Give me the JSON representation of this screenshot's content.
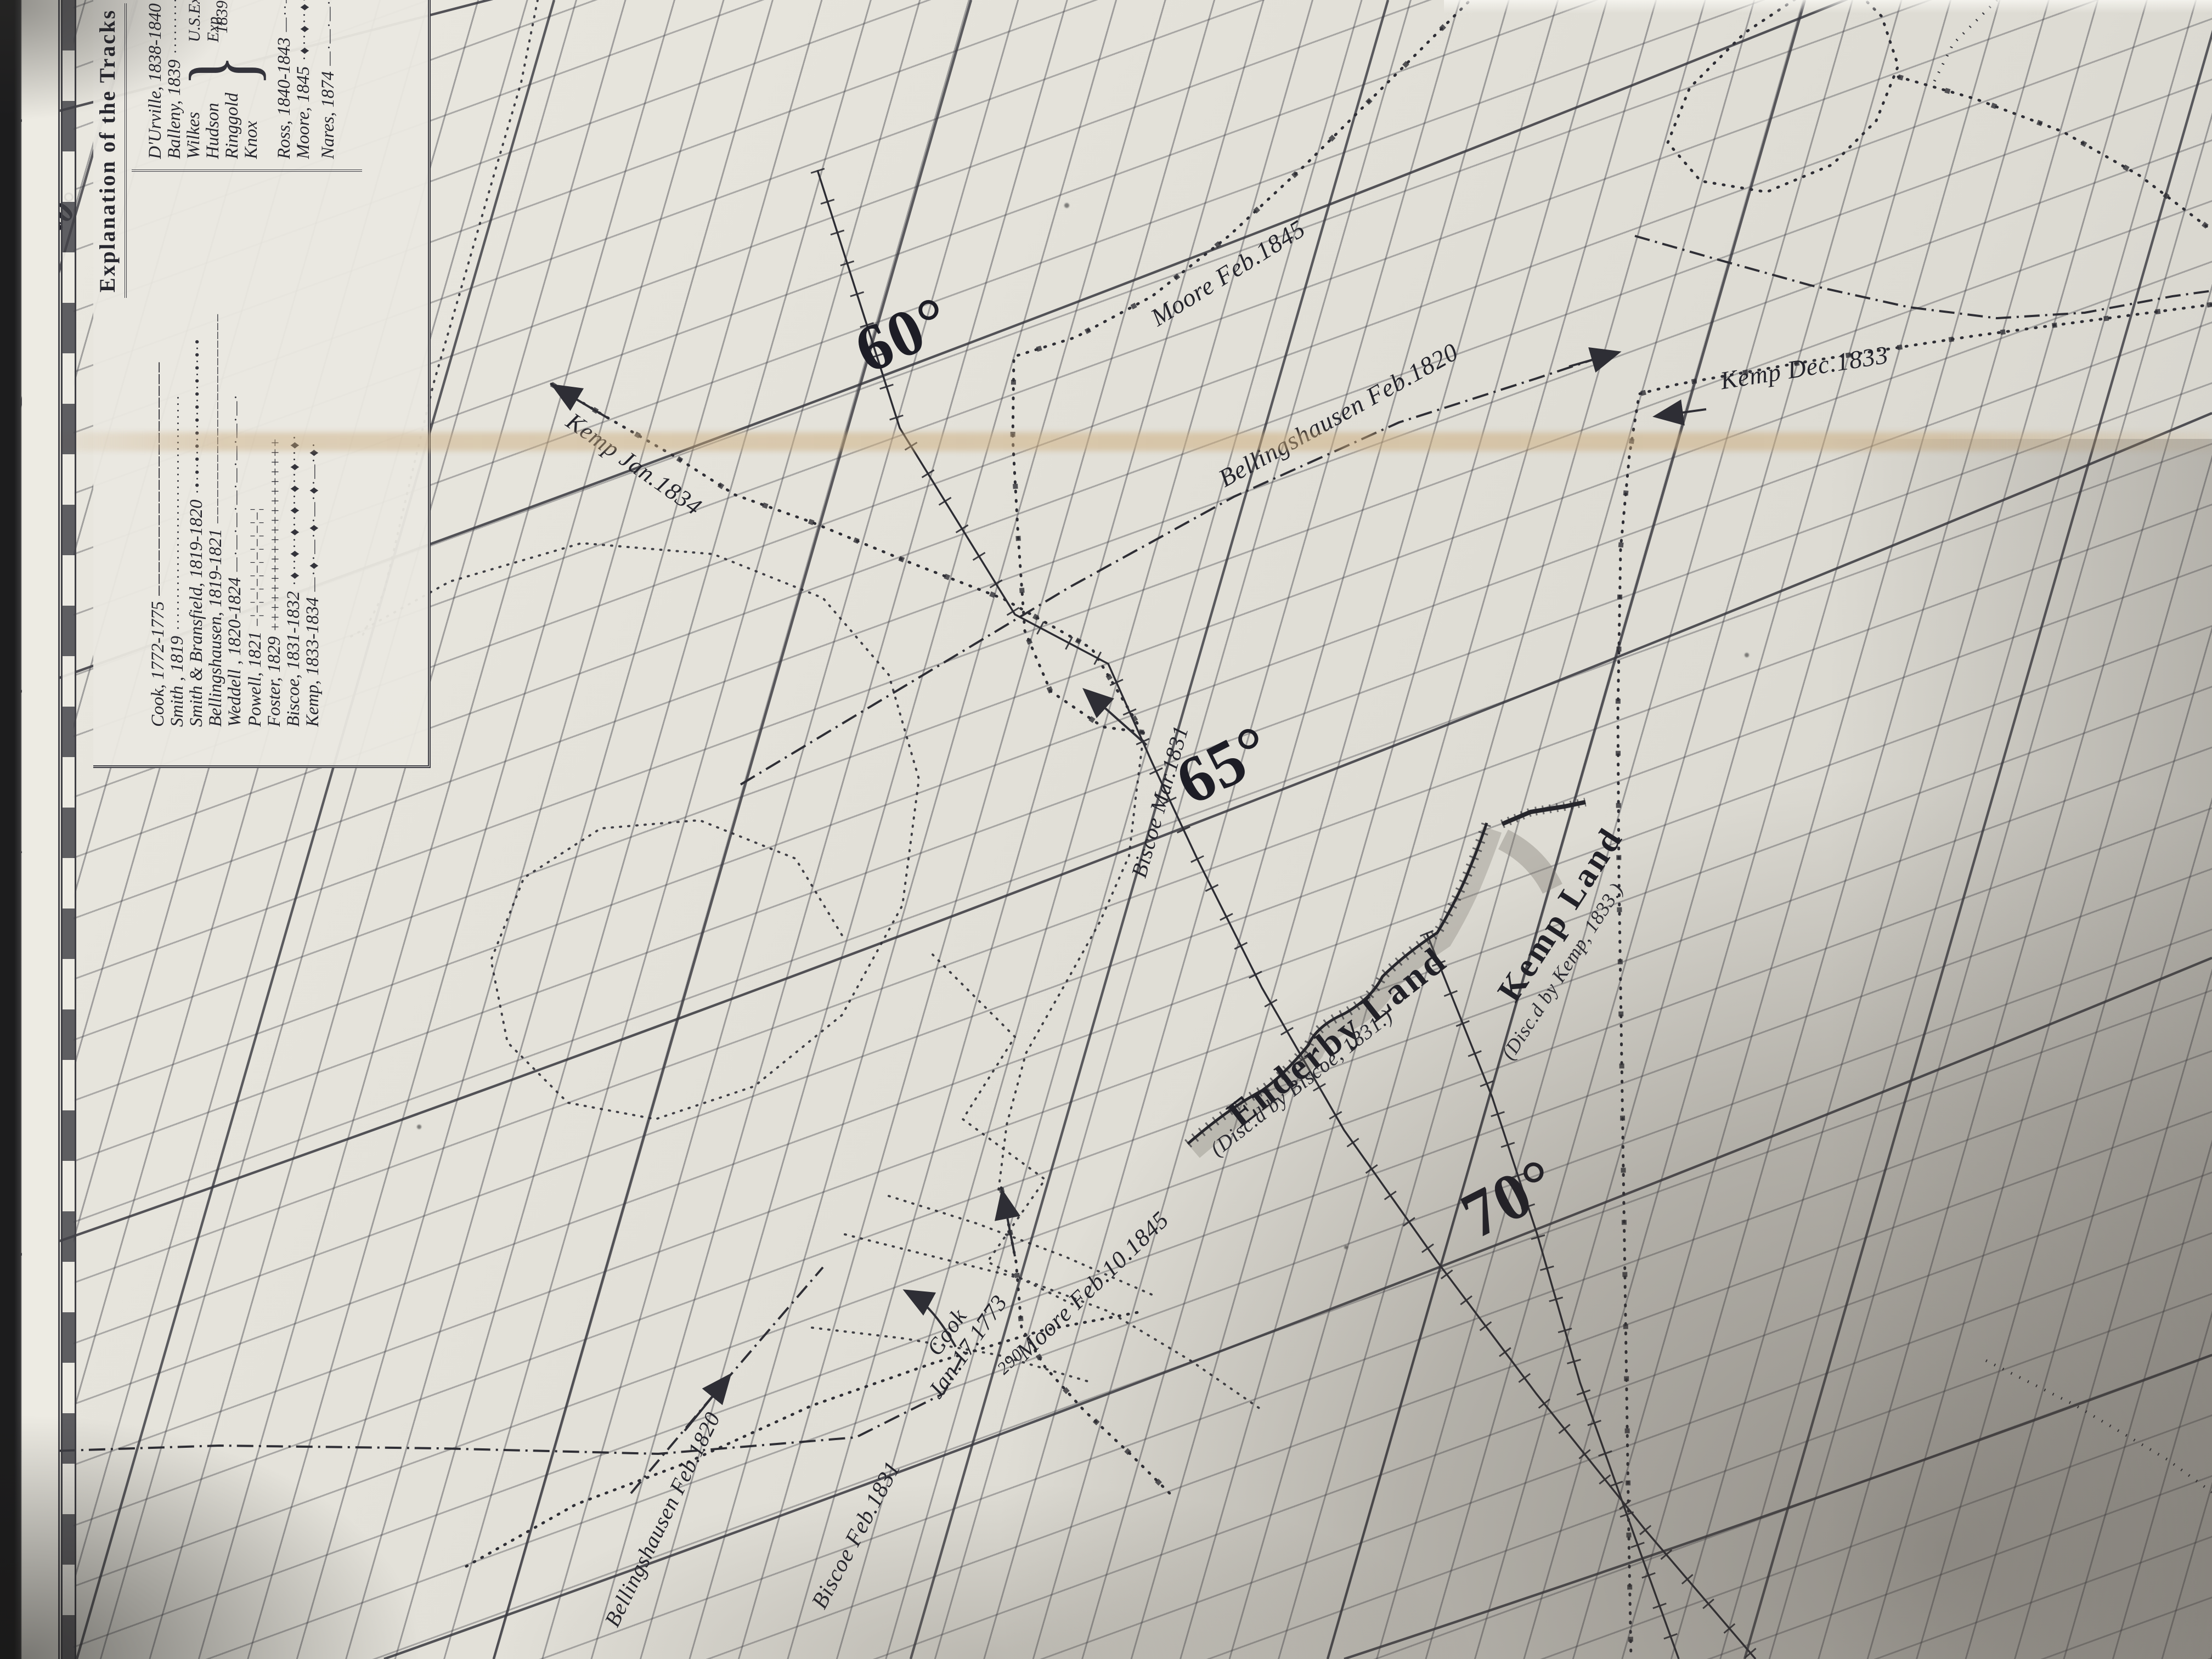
{
  "colors": {
    "paper": "#e3e1d8",
    "ink": "#24242c",
    "grid_line": "#3e3e46",
    "crease": "#c9a878"
  },
  "legend": {
    "title": "Explanation of the Tracks",
    "left_entries": [
      {
        "name": "Cook, 1772-1775",
        "sample": "────────────────────"
      },
      {
        "name": "Smith , 1819",
        "sample": "·····································"
      },
      {
        "name": "Smith & Bransfield, 1819-1820",
        "sample": "·•·•·•·•·•·•·•·•·•·•·•·•"
      },
      {
        "name": "Bellingshausen, 1819-1821",
        "sample": "––––––––––––––––––––––––"
      },
      {
        "name": "Weddell , 1820-1824",
        "sample": "—·—·—·—·—·—·—·—·"
      },
      {
        "name": "Powell, 1821",
        "sample": "–¦–¦–¦–¦–¦–¦–¦–¦–¦"
      },
      {
        "name": "Foster, 1829",
        "sample": "++++++++++++++++++++"
      },
      {
        "name": "Biscoe, 1831-1832",
        "sample": "·♦··♦··♦··♦··♦··♦··♦·"
      },
      {
        "name": "Kemp, 1833-1834",
        "sample": "—·♦·—·♦·—·♦·—·♦·"
      }
    ],
    "right_entries": [
      {
        "name": "D'Urville, 1838-1840",
        "sample": "················"
      },
      {
        "name": "Balleny, 1839",
        "sample": "················"
      },
      {
        "name": "Wilkes",
        "sample": "•·•·•·•·•·"
      },
      {
        "name": "Hudson",
        "sample": "–·–·–·–·"
      },
      {
        "name": "Ringgold",
        "sample": "··–··–··–"
      },
      {
        "name": "Knox",
        "sample": "¦–¦–¦–¦–"
      },
      {
        "name": "Ross, 1840-1843",
        "sample": "—··—··—··—"
      },
      {
        "name": "Moore, 1845",
        "sample": "·♦··♦··♦··"
      },
      {
        "name": "Nares, 1874",
        "sample": "—·—·—·—·"
      }
    ],
    "group_label_line1": "U.S.Expl.g Exp.",
    "group_label_line2": "1839-1842"
  },
  "border_labels": {
    "top": "40°",
    "middle_small": "East",
    "middle_big": "30°",
    "bottom": "20°"
  },
  "latitude_labels": {
    "l60": "60°",
    "l65": "65°",
    "l70": "70°"
  },
  "map_labels": {
    "moore_1845": "Moore Feb.1845",
    "bellingshausen_1820_upper": "Bellingshausen Feb.1820",
    "kemp_dec_1833": "Kemp Dec.1833",
    "kemp_jan_1834": "Kemp Jan.1834",
    "biscoe_mar_1831": "Biscoe Mar.1831",
    "enderby_land": "Enderby Land",
    "enderby_sub": "(Disc.d by Biscoe, 1831.)",
    "kemp_land": "Kemp Land",
    "kemp_land_sub": "(Disc.d by Kemp, 1833.)",
    "cook_line1": "Cook",
    "cook_line2": "Jan.17.1773",
    "biscoe_feb_1831": "Biscoe Feb.1831",
    "moore_feb10_1845": "Moore Feb.10.1845",
    "sounding_290": "290",
    "bellingshausen_1820_lower": "Bellingshausen Feb.1820"
  }
}
